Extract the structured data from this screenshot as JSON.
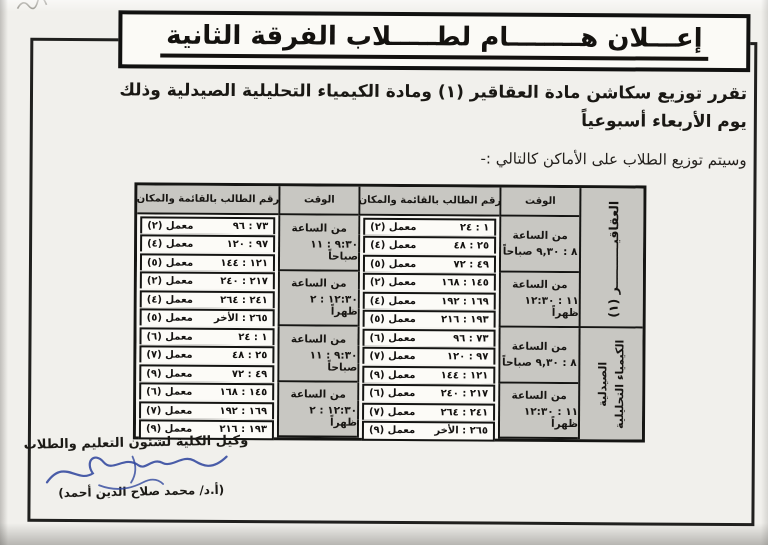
{
  "announcement": {
    "title": "إعـــلان هــــــــام لطـــــلاب الفرقة الثانية",
    "body_line1": "تقرر توزيع سكاشن مادة العقاقير (١) ومادة الكيمياء التحليلية الصيدلية وذلك",
    "body_line2": "يوم الأربعاء أسبوعياً",
    "distribution_note": "وسيتم توزيع الطلاب على الأماكن كالتالي :-"
  },
  "table": {
    "header_time": "الوقت",
    "header_student": "رقم الطالب بالقائمة والمكان",
    "time_prefix": "من الساعة"
  },
  "schedule": [
    {
      "subject_line1": "العقاقيــــــــــر (١)",
      "subject_line2": "",
      "sessions": [
        {
          "time": "٨ : ٩,٣٠ صباحاً",
          "rows": [
            {
              "range": "١ : ٢٤",
              "lab": "معمل (٢)"
            },
            {
              "range": "٢٥ : ٤٨",
              "lab": "معمل (٤)"
            },
            {
              "range": "٤٩ : ٧٢",
              "lab": "معمل (٥)"
            }
          ]
        },
        {
          "time": "٩:٣٠ : ١١ صباحاً",
          "rows": [
            {
              "range": "٧٣ : ٩٦",
              "lab": "معمل (٢)"
            },
            {
              "range": "٩٧ : ١٢٠",
              "lab": "معمل (٤)"
            },
            {
              "range": "١٢١ : ١٤٤",
              "lab": "معمل (٥)"
            }
          ]
        },
        {
          "time": "١١ : ١٢:٣٠ ظهراً",
          "rows": [
            {
              "range": "١٤٥ : ١٦٨",
              "lab": "معمل (٢)"
            },
            {
              "range": "١٦٩ : ١٩٢",
              "lab": "معمل (٤)"
            },
            {
              "range": "١٩٣ : ٢١٦",
              "lab": "معمل (٥)"
            }
          ]
        },
        {
          "time": "١٢:٣٠ : ٢ ظهراً",
          "rows": [
            {
              "range": "٢١٧ : ٢٤٠",
              "lab": "معمل (٢)"
            },
            {
              "range": "٢٤١ : ٢٦٤",
              "lab": "معمل (٤)"
            },
            {
              "range": "٢٦٥ : الأخر",
              "lab": "معمل (٥)"
            }
          ]
        }
      ]
    },
    {
      "subject_line1": "الكيمياء التحليلية",
      "subject_line2": "الصيدلية",
      "sessions": [
        {
          "time": "٨ : ٩,٣٠ صباحاً",
          "rows": [
            {
              "range": "٧٣ : ٩٦",
              "lab": "معمل (٦)"
            },
            {
              "range": "٩٧ : ١٢٠",
              "lab": "معمل (٧)"
            },
            {
              "range": "١٢١ : ١٤٤",
              "lab": "معمل (٩)"
            }
          ]
        },
        {
          "time": "٩:٣٠ : ١١ صباحاً",
          "rows": [
            {
              "range": "١ : ٢٤",
              "lab": "معمل (٦)"
            },
            {
              "range": "٢٥ : ٤٨",
              "lab": "معمل (٧)"
            },
            {
              "range": "٤٩ : ٧٢",
              "lab": "معمل (٩)"
            }
          ]
        },
        {
          "time": "١١ : ١٢:٣٠ ظهراً",
          "rows": [
            {
              "range": "٢١٧ : ٢٤٠",
              "lab": "معمل (٦)"
            },
            {
              "range": "٢٤١ : ٢٦٤",
              "lab": "معمل (٧)"
            },
            {
              "range": "٢٦٥ : الأخر",
              "lab": "معمل (٩)"
            }
          ]
        },
        {
          "time": "١٢:٣٠ : ٢ ظهراً",
          "rows": [
            {
              "range": "١٤٥ : ١٦٨",
              "lab": "معمل (٦)"
            },
            {
              "range": "١٦٩ : ١٩٢",
              "lab": "معمل (٧)"
            },
            {
              "range": "١٩٣ : ٢١٦",
              "lab": "معمل (٩)"
            }
          ]
        }
      ]
    }
  ],
  "signature": {
    "role": "وكيل الكلية لشئون التعليم والطلاب",
    "name": "(أ.د/ محمد صلاح الدين أحمد)"
  }
}
